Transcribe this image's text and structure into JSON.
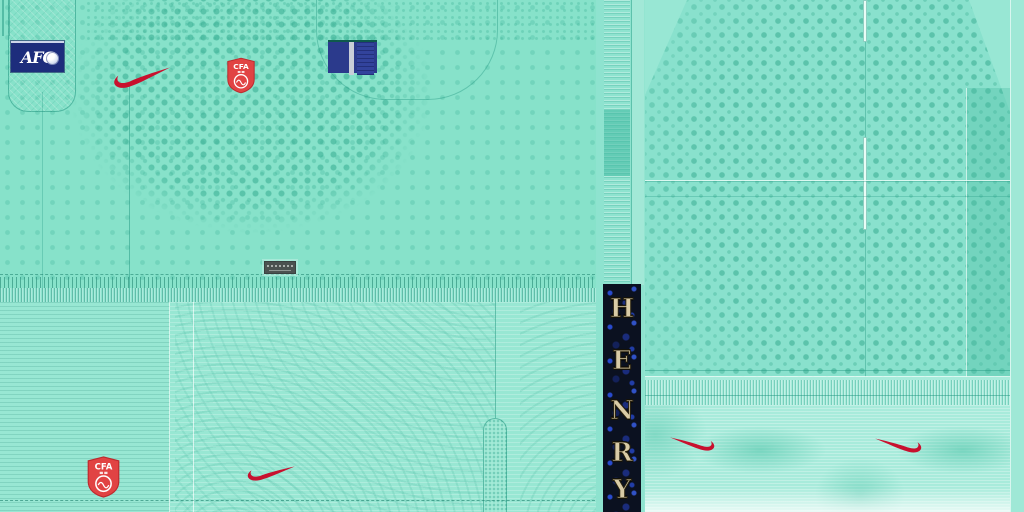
{
  "sheet": {
    "kind": "football-kit-texture-sheet",
    "player_name": "HENRY"
  },
  "badges": {
    "afc": {
      "label": "AFC",
      "bg": "#1d2d7c",
      "text_color": "#ffffff"
    },
    "cfa_front": {
      "label": "CFA"
    },
    "cfa_shorts": {
      "label": "CFA"
    },
    "cfa_red": "#e14343"
  },
  "brand": {
    "swoosh_color": "#c8102e",
    "swoosh_count": 4
  },
  "name_strip": {
    "name": "HENRY",
    "letters": [
      "H",
      "E",
      "N",
      "R",
      "Y"
    ],
    "bg": "#0b1120",
    "letter_color": "#d9cba6"
  },
  "colors": {
    "base_mint": "#87e2ca",
    "shorts_mint": "#98e7d3",
    "back_mint": "#89e1cd",
    "sock_mint": "#a8ebdb",
    "dot_teal": "#2fa68a",
    "patch_navy": "#2b3a8c",
    "patch_bar": "#c9ced8",
    "tag_gray": "#4b5250"
  }
}
